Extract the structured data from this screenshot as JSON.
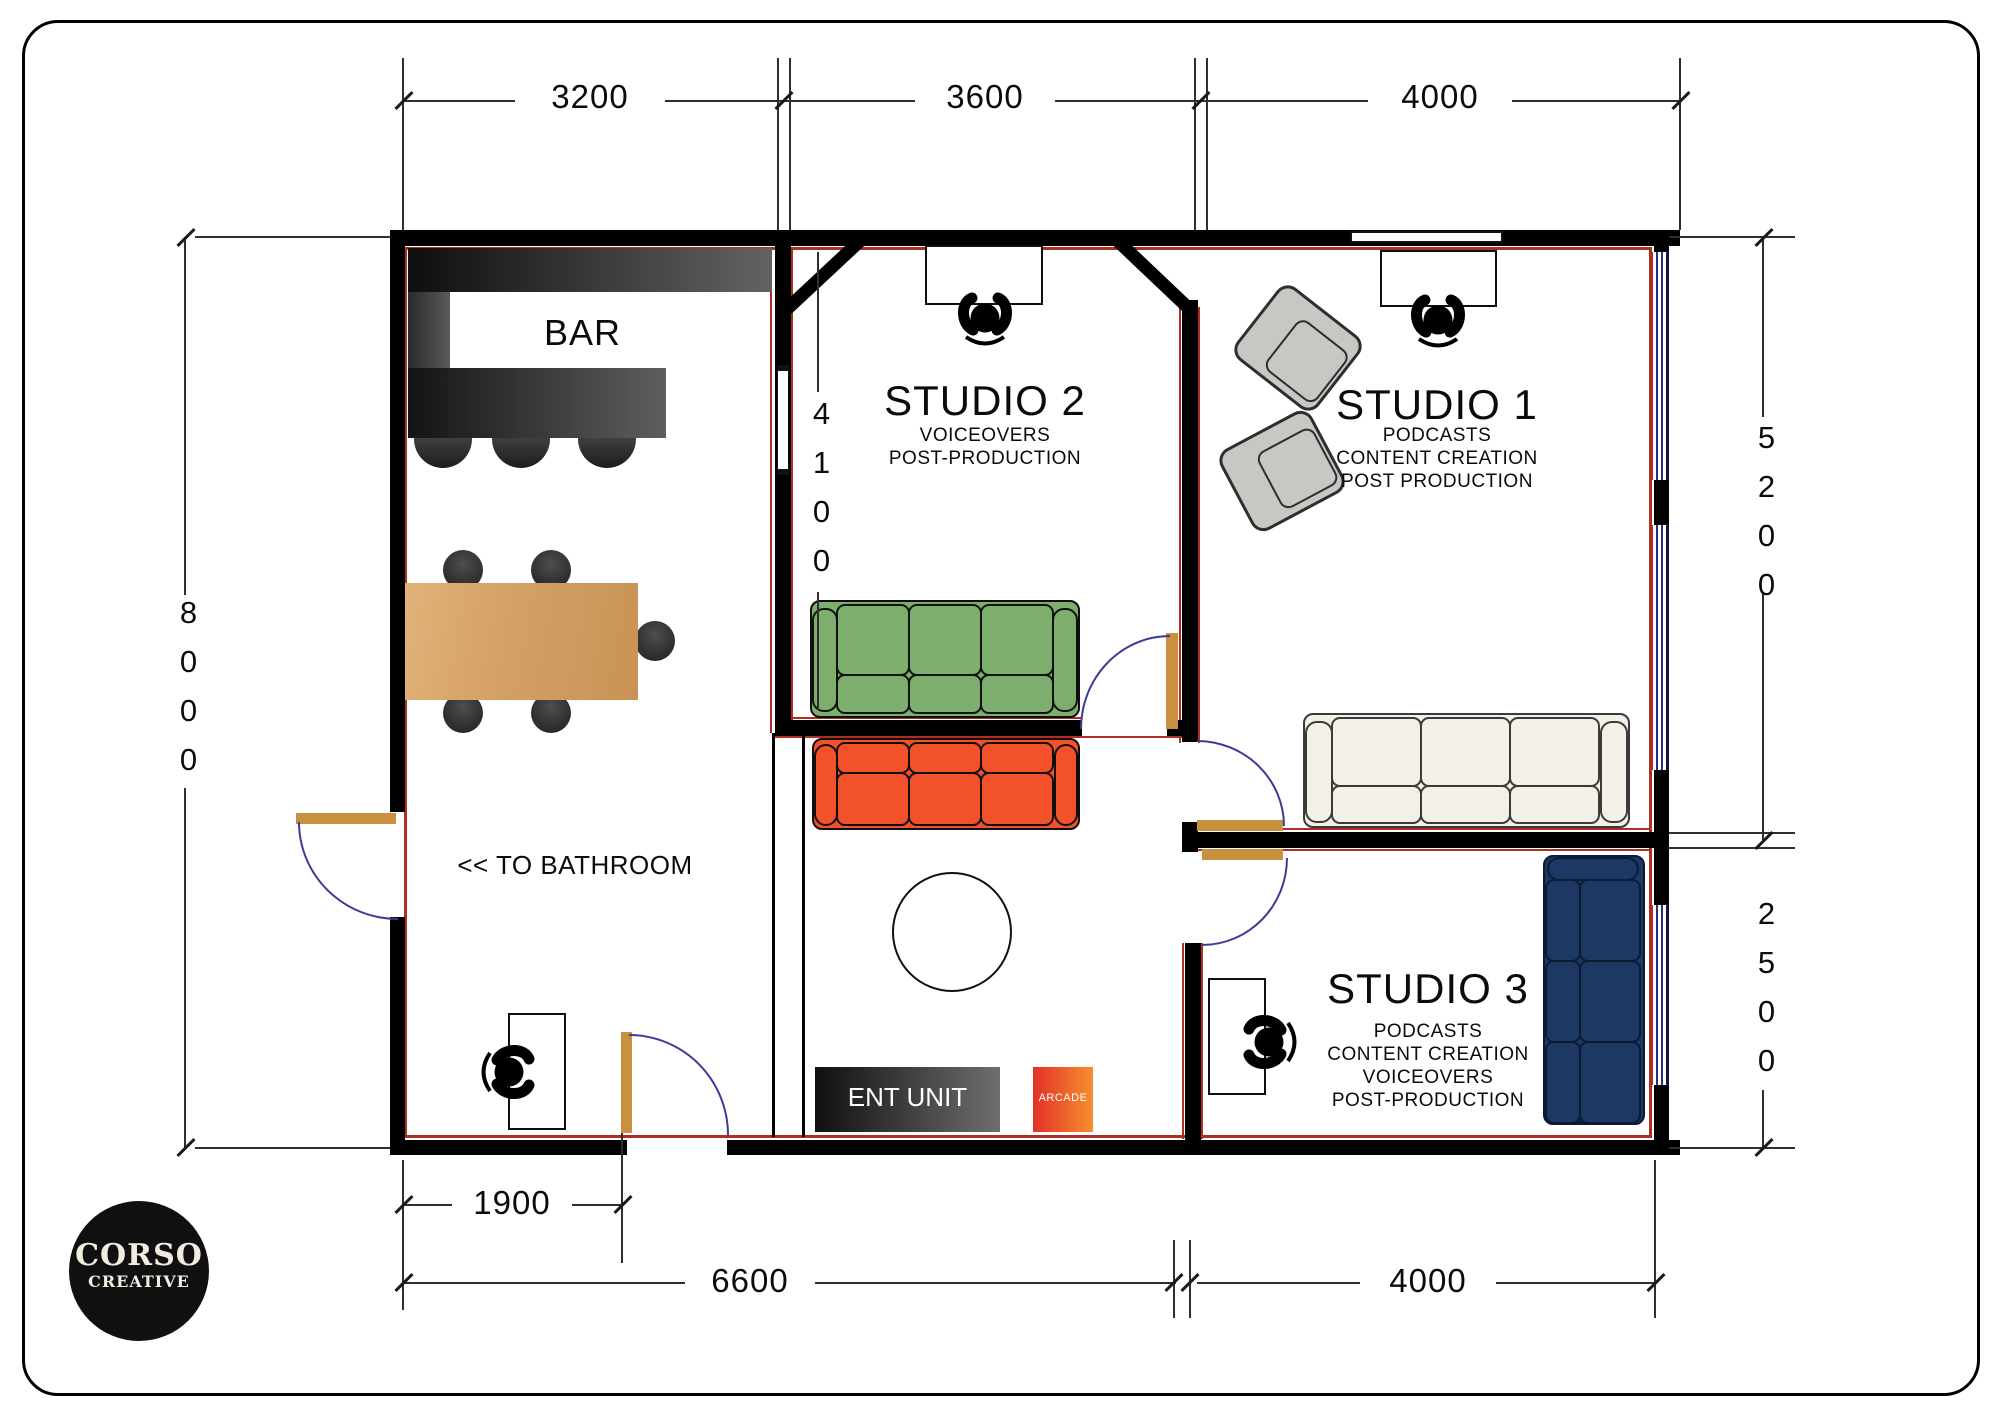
{
  "logo": {
    "line1": "CORSO",
    "line2": "CREATIVE"
  },
  "rooms": {
    "bar": {
      "label": "BAR",
      "bathroom_note": "<< TO BATHROOM"
    },
    "studio2": {
      "name": "STUDIO 2",
      "services": [
        "VOICEOVERS",
        "POST-PRODUCTION"
      ]
    },
    "studio1": {
      "name": "STUDIO 1",
      "services": [
        "PODCASTS",
        "CONTENT CREATION",
        "POST PRODUCTION"
      ]
    },
    "studio3": {
      "name": "STUDIO 3",
      "services": [
        "PODCASTS",
        "CONTENT CREATION",
        "VOICEOVERS",
        "POST-PRODUCTION"
      ]
    },
    "lounge": {
      "ent_unit_label": "ENT UNIT",
      "arcade_label": "ARCADE"
    }
  },
  "dimensions": {
    "top": [
      "3200",
      "3600",
      "4000"
    ],
    "left_total": "8000",
    "right_upper": "5200",
    "right_lower": "2500",
    "interior_studio2": "4100",
    "bottom_door_offset": "1900",
    "bottom_left_span": "6600",
    "bottom_right_span": "4000"
  },
  "colors": {
    "wall": "#000000",
    "accent_red": "#AF2F23",
    "door": "#C9913F",
    "swing_arc": "#3C3C96",
    "sofa_green": "#7CAE6E",
    "sofa_orange": "#F2512A",
    "sofa_cream": "#F3F0E7",
    "sofa_navy": "#1E3864",
    "wood": "#D8A76B",
    "chair_grey": "#C8C7C4"
  }
}
